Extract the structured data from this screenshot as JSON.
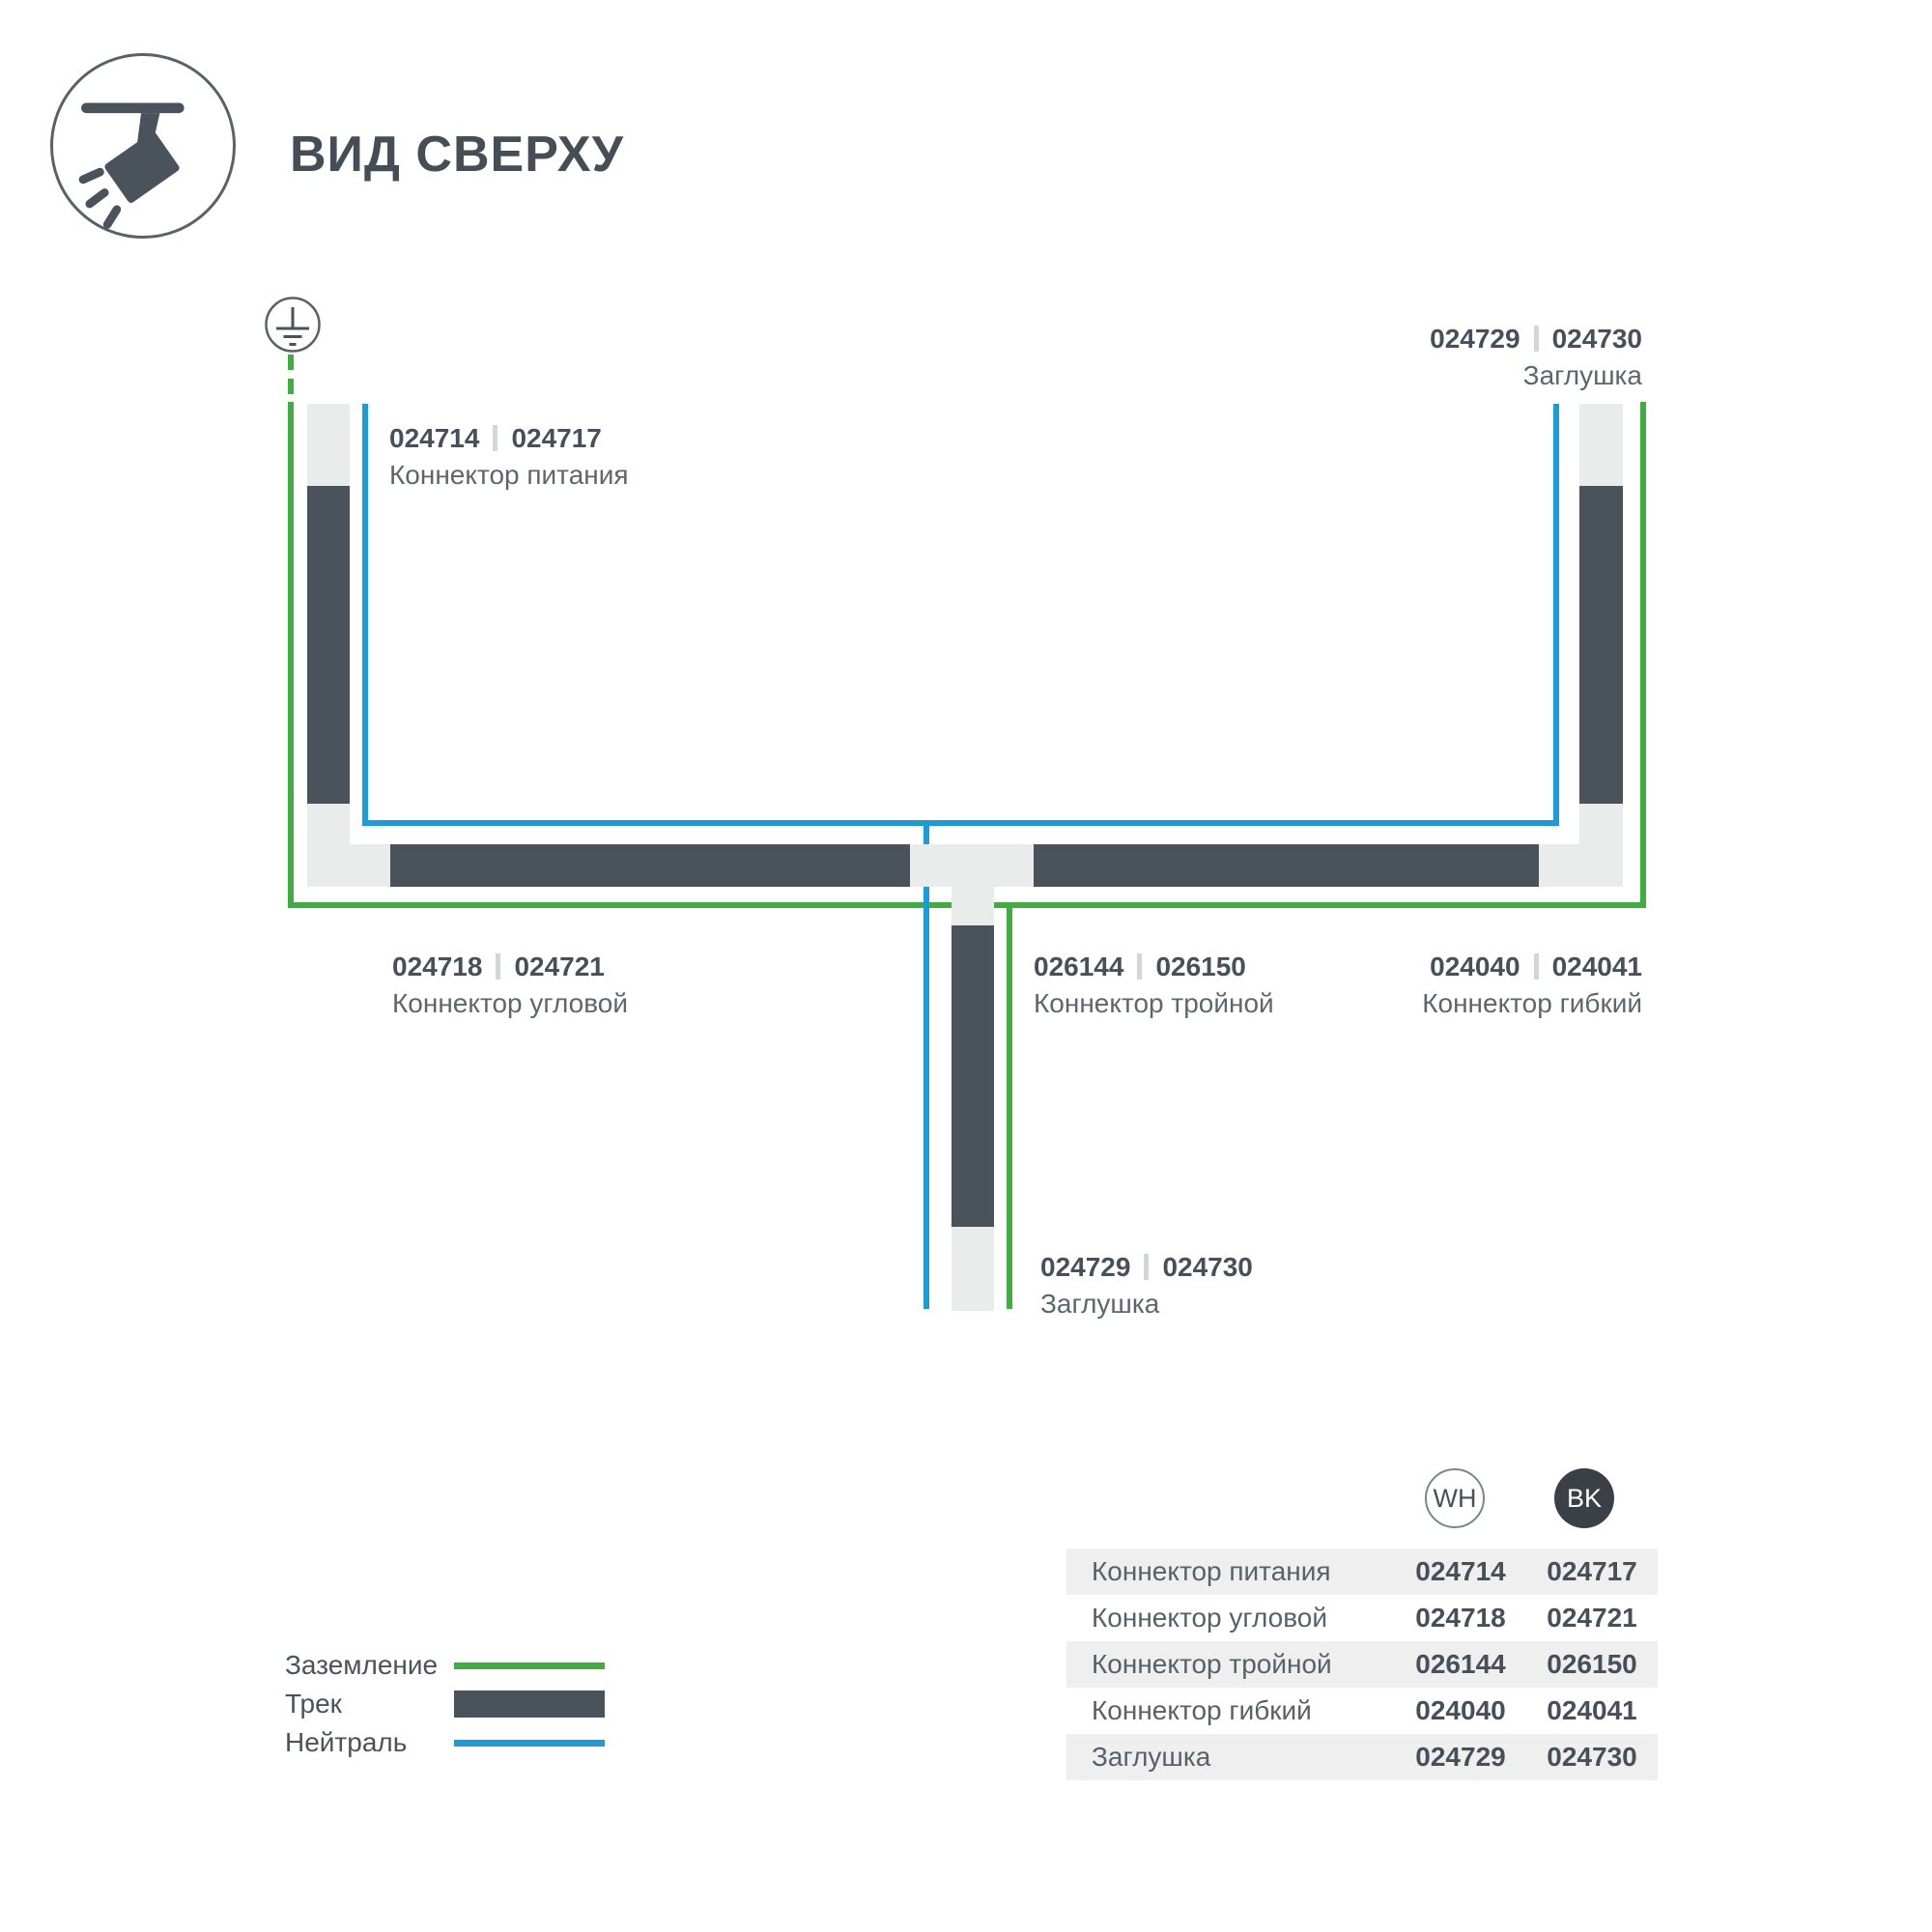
{
  "page": {
    "title": "ВИД СВЕРХУ"
  },
  "icons": {
    "logo": "track-spotlight-icon",
    "ground": "earth-ground-icon"
  },
  "colors": {
    "ground_green": "#3fae3e",
    "neutral_blue": "#1b9cd8",
    "track_dark": "#4a535c",
    "connector_light": "#eaeceb",
    "text_dark": "#47505a",
    "text_muted": "#5d666e",
    "bk_badge": "#3a4046"
  },
  "diagram": {
    "labels": {
      "power": {
        "code_wh": "024714",
        "code_bk": "024717",
        "name": "Коннектор питания"
      },
      "cap_top": {
        "code_wh": "024729",
        "code_bk": "024730",
        "name": "Заглушка"
      },
      "corner": {
        "code_wh": "024718",
        "code_bk": "024721",
        "name": "Коннектор угловой"
      },
      "triple": {
        "code_wh": "026144",
        "code_bk": "026150",
        "name": "Коннектор тройной"
      },
      "flex": {
        "code_wh": "024040",
        "code_bk": "024041",
        "name": "Коннектор гибкий"
      },
      "cap_bottom": {
        "code_wh": "024729",
        "code_bk": "024730",
        "name": "Заглушка"
      }
    }
  },
  "legend": {
    "items": [
      {
        "label": "Заземление",
        "swatch": "ground"
      },
      {
        "label": "Трек",
        "swatch": "track"
      },
      {
        "label": "Нейтраль",
        "swatch": "neutral"
      }
    ]
  },
  "table": {
    "columns": [
      {
        "code": "WH"
      },
      {
        "code": "BK"
      }
    ],
    "rows": [
      {
        "name": "Коннектор питания",
        "wh": "024714",
        "bk": "024717"
      },
      {
        "name": "Коннектор угловой",
        "wh": "024718",
        "bk": "024721"
      },
      {
        "name": "Коннектор тройной",
        "wh": "026144",
        "bk": "026150"
      },
      {
        "name": "Коннектор гибкий",
        "wh": "024040",
        "bk": "024041"
      },
      {
        "name": "Заглушка",
        "wh": "024729",
        "bk": "024730"
      }
    ]
  }
}
